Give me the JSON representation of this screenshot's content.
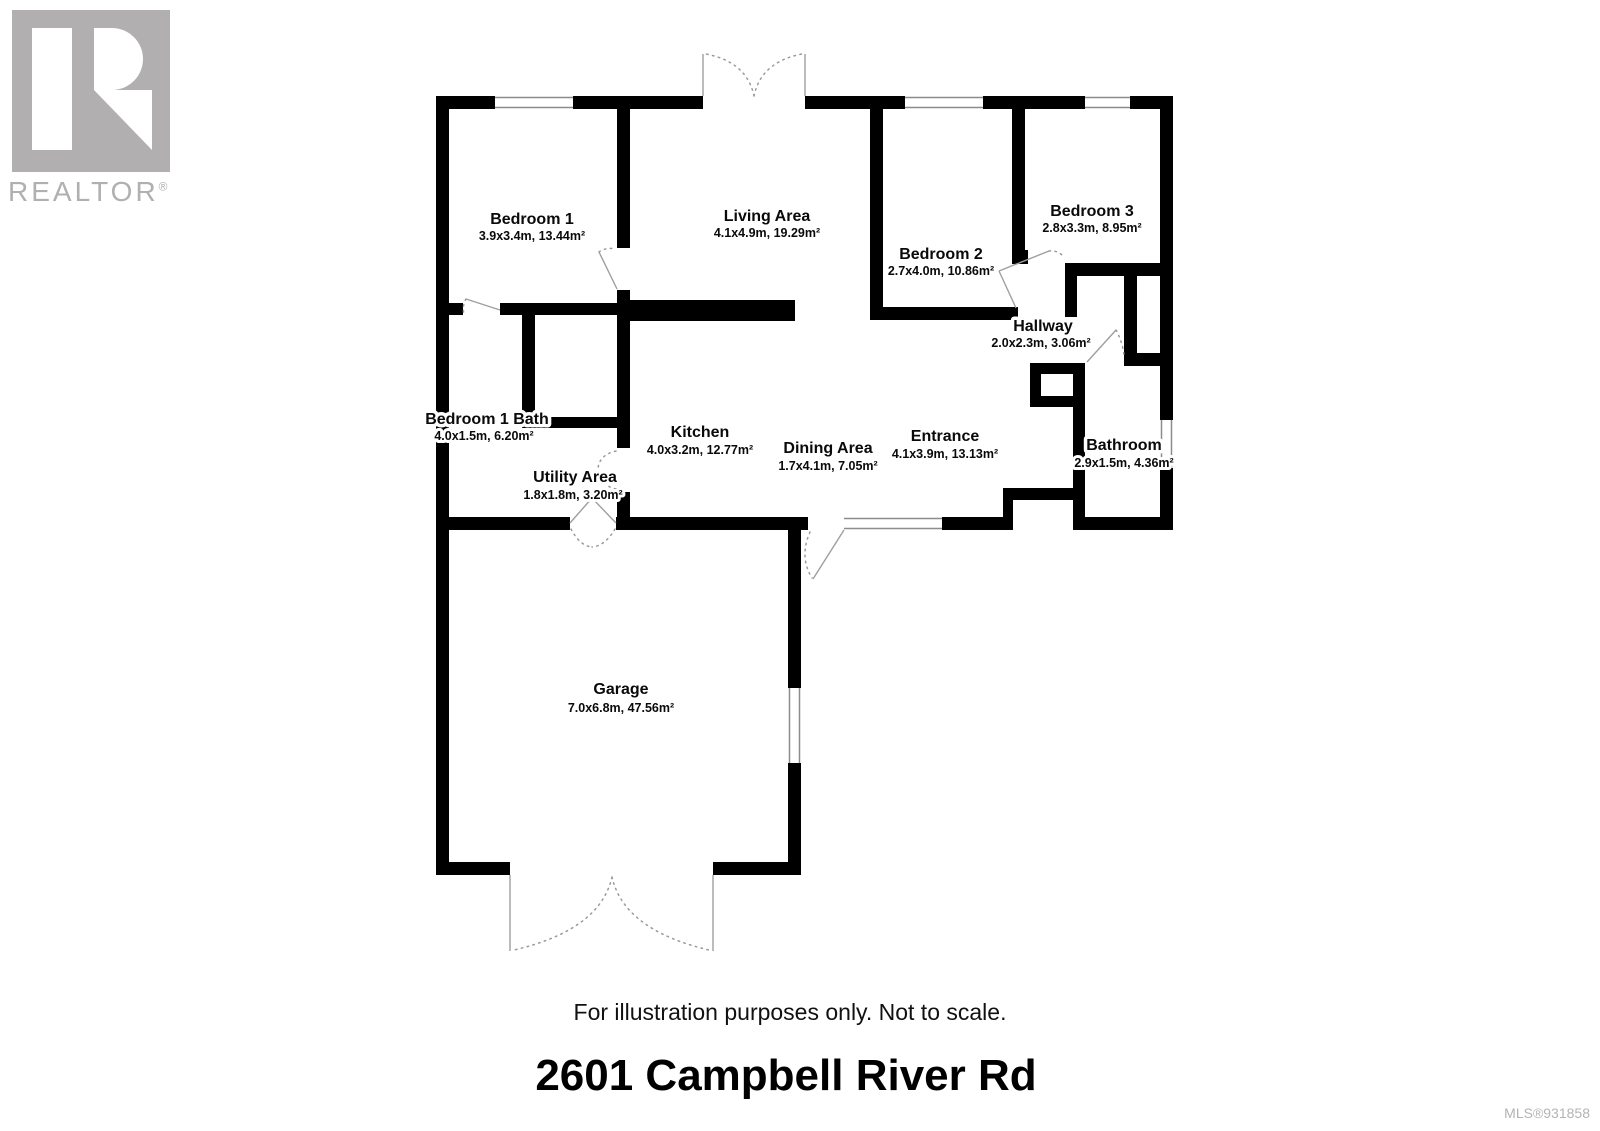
{
  "branding": {
    "logo_text": "REALTOR",
    "registered": "®"
  },
  "plan": {
    "rooms": [
      {
        "id": "bedroom-1",
        "name": "Bedroom 1",
        "dims": "3.9x3.4m, 13.44m²"
      },
      {
        "id": "living-area",
        "name": "Living Area",
        "dims": "4.1x4.9m, 19.29m²"
      },
      {
        "id": "bedroom-2",
        "name": "Bedroom 2",
        "dims": "2.7x4.0m, 10.86m²"
      },
      {
        "id": "bedroom-3",
        "name": "Bedroom 3",
        "dims": "2.8x3.3m, 8.95m²"
      },
      {
        "id": "hallway",
        "name": "Hallway",
        "dims": "2.0x2.3m, 3.06m²"
      },
      {
        "id": "bedroom-1-bath",
        "name": "Bedroom 1 Bath",
        "dims": "4.0x1.5m, 6.20m²"
      },
      {
        "id": "kitchen",
        "name": "Kitchen",
        "dims": "4.0x3.2m, 12.77m²"
      },
      {
        "id": "utility-area",
        "name": "Utility Area",
        "dims": "1.8x1.8m, 3.20m²"
      },
      {
        "id": "dining-area",
        "name": "Dining Area",
        "dims": "1.7x4.1m, 7.05m²"
      },
      {
        "id": "entrance",
        "name": "Entrance",
        "dims": "4.1x3.9m, 13.13m²"
      },
      {
        "id": "bathroom",
        "name": "Bathroom",
        "dims": "2.9x1.5m, 4.36m²"
      },
      {
        "id": "garage",
        "name": "Garage",
        "dims": "7.0x6.8m, 47.56m²"
      }
    ]
  },
  "footer": {
    "disclaimer": "For illustration purposes only. Not to scale.",
    "address": "2601 Campbell River Rd",
    "mls_number": "MLS®931858"
  },
  "colors": {
    "wall": "#000000",
    "logo_gray": "#b1afb0",
    "muted_gray": "#b5b3b4",
    "window_line": "#8c8c8c",
    "door_line": "#9a9a9a"
  }
}
